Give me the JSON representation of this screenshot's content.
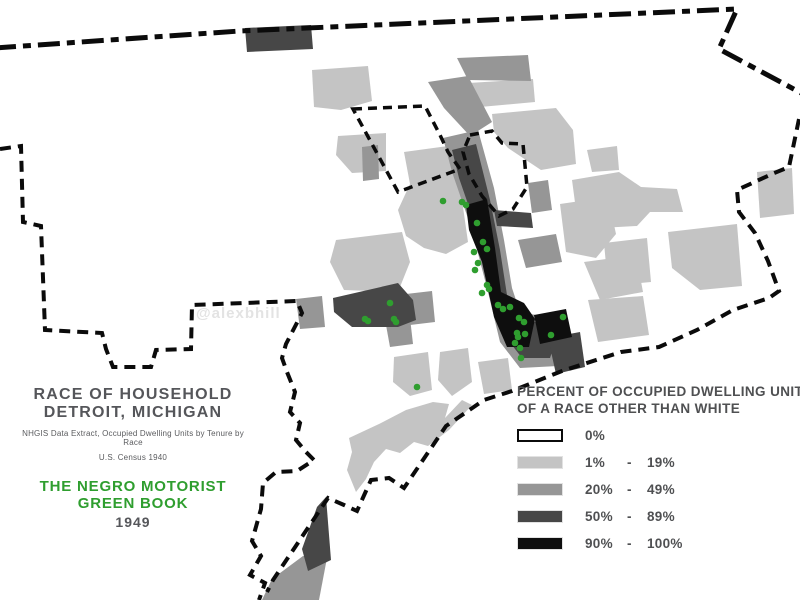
{
  "watermark": "@alexbhill",
  "title_block": {
    "line1": "RACE OF HOUSEHOLD",
    "line2": "DETROIT, MICHIGAN",
    "source1": "NHGIS Data Extract, Occupied Dwelling Units by Tenure by Race",
    "source2": "U.S. Census 1940",
    "green_line1": "THE NEGRO MOTORIST",
    "green_line2": "GREEN BOOK",
    "year": "1949"
  },
  "legend": {
    "title_line1": "PERCENT OF OCCUPIED DWELLING UNITS",
    "title_line2": "OF A RACE OTHER THAN WHITE",
    "items": [
      {
        "min": "0%",
        "dash": "",
        "max": "",
        "shade": "none",
        "color": "#ffffff"
      },
      {
        "min": "1%",
        "dash": "-",
        "max": "19%",
        "shade": "light",
        "color": "#c4c4c4"
      },
      {
        "min": "20%",
        "dash": "-",
        "max": "49%",
        "shade": "medium",
        "color": "#969696"
      },
      {
        "min": "50%",
        "dash": "-",
        "max": "89%",
        "shade": "dark",
        "color": "#474747"
      },
      {
        "min": "90%",
        "dash": "-",
        "max": "100%",
        "shade": "black",
        "color": "#0e0e0e"
      }
    ]
  },
  "colors": {
    "light": "#c4c4c4",
    "medium": "#969696",
    "dark": "#474747",
    "black": "#0e0e0e",
    "green": "#2f9e2f",
    "boundary": "#0b0b0b",
    "heading_text": "#55565a",
    "watermark_text": "#e3e3e3"
  },
  "map": {
    "county_boundary": "M -6 48 L 240 31 L 737 9 L 719 49 L 803 94",
    "city_boundary_west": "M 0 149 L 21 146 L 23 222 L 41 226 L 45 330 L 102 333 L 106 349 L 113 367 L 151 367 L 156 350 L 191 349 L 192 305 L 297 301 L 302 313 L 286 344 L 282 358 L 287 372 L 295 392 L 290 412 L 300 423 L 296 440 L 306 452 L 314 460 L 297 471 L 276 472 L 263 483 L 261 509 L 252 541 L 261 556 L 250 575 L 265 583 L 259 600",
    "city_boundary_river": "M 799 119 L 789 167 L 772 174 L 737 190 L 739 212 L 755 233 L 768 261 L 779 291 L 769 298 L 733 310 L 697 330 L 659 347 L 621 352 L 562 371 L 512 391 L 484 400 L 446 426 L 404 488 L 389 478 L 371 480 L 366 491 L 357 511 L 344 505 L 328 498 L 273 580 L 267 592",
    "enclave_highland_park": "M 353 109 L 425 106 L 440 135 L 448 152 L 460 169 L 398 192 Z",
    "enclave_hamtramck": "M 470 135 L 492 131 L 502 143 L 523 144 L 527 187 L 513 209 L 499 216 L 482 196 L 469 174 L 463 152 Z",
    "tracts": [
      {
        "shade": "light",
        "points": "312,70 368,66 372,101 341,110 314,107"
      },
      {
        "shade": "light",
        "points": "436,85 533,79 535,102 469,108 440,100"
      },
      {
        "shade": "light",
        "points": "492,114 556,108 573,130 576,164 541,170 508,148 494,132"
      },
      {
        "shade": "light",
        "points": "338,136 386,133 386,171 352,173 336,155"
      },
      {
        "shade": "light",
        "points": "404,152 448,146 462,200 468,242 446,254 424,248 406,236 398,210 410,184"
      },
      {
        "shade": "light",
        "points": "336,240 402,232 410,262 398,292 344,290 330,262"
      },
      {
        "shade": "light",
        "points": "560,204 608,197 616,234 596,258 566,252"
      },
      {
        "shade": "light",
        "points": "584,262 636,255 643,292 600,300"
      },
      {
        "shade": "light",
        "points": "588,300 643,296 649,335 598,342"
      },
      {
        "shade": "light",
        "points": "587,150 617,146 619,170 592,172"
      },
      {
        "shade": "light",
        "points": "572,180 619,172 641,187 677,189 683,212 650,212 637,226 600,228 576,210"
      },
      {
        "shade": "light",
        "points": "604,243 647,238 651,282 608,286"
      },
      {
        "shade": "light",
        "points": "668,232 737,224 742,286 700,290 672,268"
      },
      {
        "shade": "light",
        "points": "757,172 792,168 794,214 760,218"
      },
      {
        "shade": "light",
        "points": "394,357 428,352 432,390 410,396 393,382"
      },
      {
        "shade": "light",
        "points": "440,352 468,348 472,382 452,396 438,380"
      },
      {
        "shade": "light",
        "points": "478,362 508,358 512,390 484,394"
      },
      {
        "shade": "light",
        "points": "349,438 379,424 406,410 433,402 449,404 445,418 462,400 472,405 449,430 428,446 414,442 400,453 386,449 374,462 366,479 356,492 347,470 352,452"
      },
      {
        "shade": "medium",
        "points": "457,58 528,55 531,81 468,80"
      },
      {
        "shade": "medium",
        "points": "428,82 468,76 492,122 470,136 444,108"
      },
      {
        "shade": "medium",
        "points": "443,138 478,130 494,188 504,240 512,288 520,312 552,318 566,336 558,366 520,368 500,342 488,292 472,230 452,172"
      },
      {
        "shade": "medium",
        "points": "362,147 378,145 379,179 363,181"
      },
      {
        "shade": "medium",
        "points": "528,183 548,180 552,210 532,213"
      },
      {
        "shade": "medium",
        "points": "296,299 322,296 325,327 300,329"
      },
      {
        "shade": "medium",
        "points": "384,314 409,309 413,344 390,347"
      },
      {
        "shade": "medium",
        "points": "406,294 432,291 435,322 410,325"
      },
      {
        "shade": "medium",
        "points": "518,240 556,234 562,262 526,268"
      },
      {
        "shade": "medium",
        "points": "303,556 327,558 319,600 262,600 272,579"
      },
      {
        "shade": "dark",
        "points": "245,28 311,25 313,49 247,52"
      },
      {
        "shade": "dark",
        "points": "452,150 476,144 490,200 500,250 507,295 516,318 545,324 556,340 550,358 522,358 505,336 493,288 477,230 459,178"
      },
      {
        "shade": "dark",
        "points": "333,298 398,283 413,300 416,320 398,327 352,327 334,312"
      },
      {
        "shade": "dark",
        "points": "326,497 331,560 308,571 302,549 317,507"
      },
      {
        "shade": "dark",
        "points": "548,338 580,332 585,367 556,374"
      },
      {
        "shade": "dark",
        "points": "494,210 531,213 533,228 497,226"
      },
      {
        "shade": "black",
        "points": "466,205 487,199 495,248 501,292 524,303 535,319 529,347 507,347 494,317 482,262 469,230"
      },
      {
        "shade": "black",
        "points": "534,315 566,309 572,337 540,344"
      }
    ],
    "green_book_locations": [
      [
        443,
        201
      ],
      [
        462,
        202
      ],
      [
        466,
        205
      ],
      [
        477,
        223
      ],
      [
        483,
        242
      ],
      [
        474,
        252
      ],
      [
        487,
        249
      ],
      [
        478,
        263
      ],
      [
        475,
        270
      ],
      [
        487,
        285
      ],
      [
        482,
        293
      ],
      [
        489,
        289
      ],
      [
        498,
        305
      ],
      [
        503,
        309
      ],
      [
        510,
        307
      ],
      [
        519,
        318
      ],
      [
        524,
        322
      ],
      [
        517,
        333
      ],
      [
        525,
        334
      ],
      [
        515,
        343
      ],
      [
        520,
        348
      ],
      [
        521,
        358
      ],
      [
        563,
        317
      ],
      [
        551,
        335
      ],
      [
        518,
        337
      ],
      [
        390,
        303
      ],
      [
        365,
        319
      ],
      [
        368,
        321
      ],
      [
        394,
        319
      ],
      [
        396,
        322
      ],
      [
        417,
        387
      ]
    ]
  }
}
